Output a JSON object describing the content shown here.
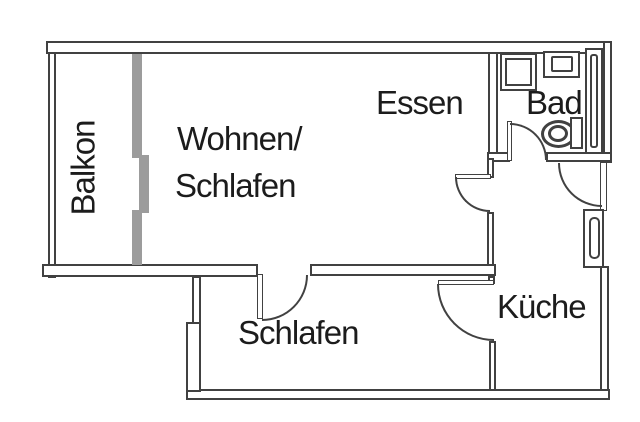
{
  "labels": {
    "balkon": "Balkon",
    "wohnen_line1": "Wohnen/",
    "wohnen_line2": "Schlafen",
    "essen": "Essen",
    "bad": "Bad",
    "kueche": "Küche",
    "schlafen": "Schlafen"
  },
  "colors": {
    "wall": "#414141",
    "glass": "#9c9c9c",
    "background": "#ffffff",
    "text": "#1c1c1c"
  },
  "fixtures": {
    "shower": "shower-tray",
    "sink": "washbasin",
    "toilet": "toilet",
    "bad_window": "bathroom-window-strip",
    "kueche_window": "kitchen-window",
    "balcony_slider": "balcony-sliding-door"
  }
}
